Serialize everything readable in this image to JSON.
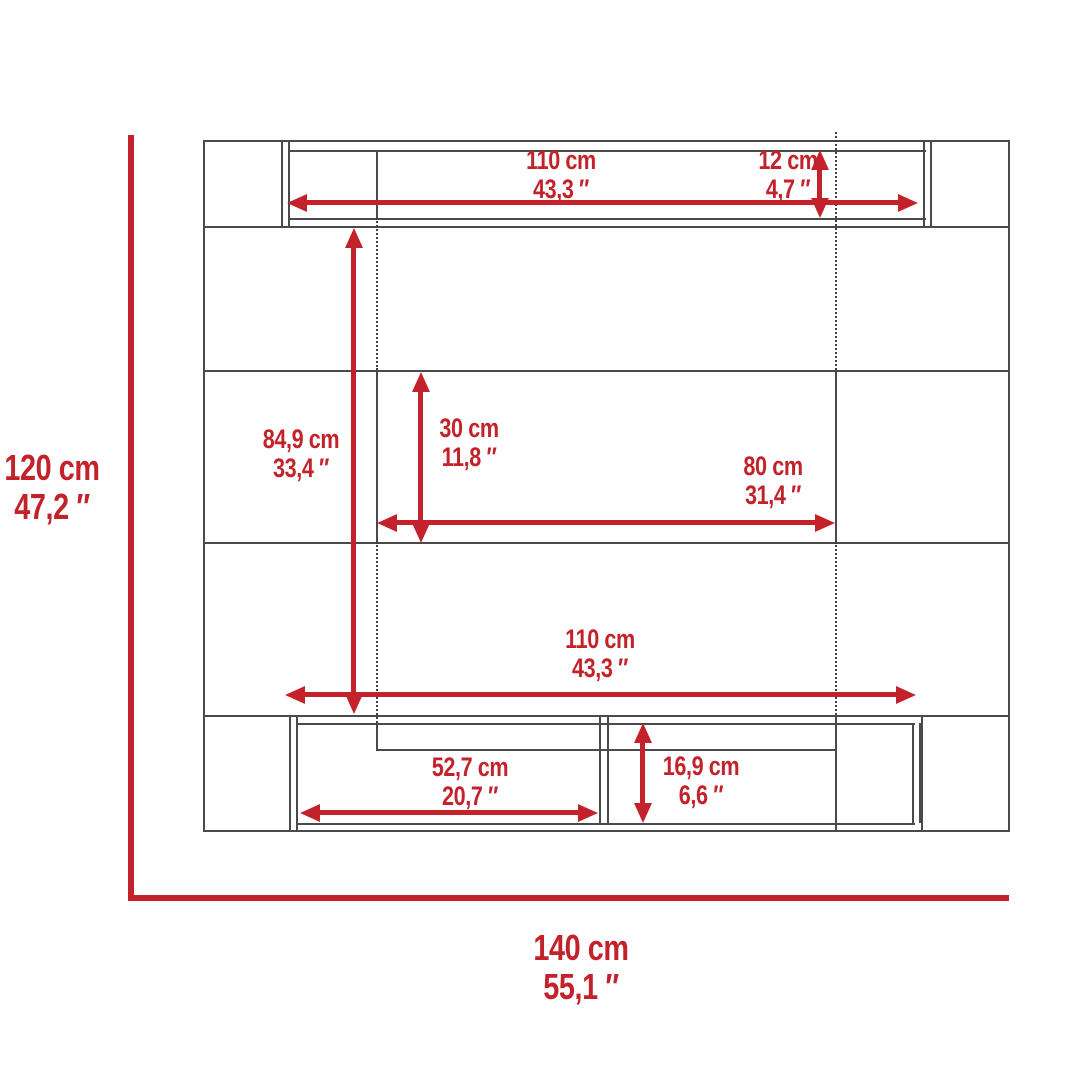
{
  "page": {
    "background": "#ffffff"
  },
  "diagram": {
    "type": "furniture-dimension-diagram",
    "description": "Front-view technical drawing of a wall-mounted entertainment center with dimension arrows",
    "accent_color": "#c4222a",
    "line_color": "#4a4a4a",
    "dimensions": {
      "top_shelf_width": {
        "cm": "110 cm",
        "inch": "43,3 ″"
      },
      "top_shelf_height": {
        "cm": "12 cm",
        "inch": "4,7 ″"
      },
      "overall_height": {
        "cm": "120 cm",
        "inch": "47,2 ″"
      },
      "panel_height": {
        "cm": "84,9 cm",
        "inch": "33,4 ″"
      },
      "center_opening_height": {
        "cm": "30 cm",
        "inch": "11,8 ″"
      },
      "center_shelf_width": {
        "cm": "80 cm",
        "inch": "31,4 ″"
      },
      "lower_opening_width": {
        "cm": "110 cm",
        "inch": "43,3 ″"
      },
      "cabinet_compartment_width": {
        "cm": "52,7 cm",
        "inch": "20,7 ″"
      },
      "cabinet_opening_height": {
        "cm": "16,9 cm",
        "inch": "6,6 ″"
      },
      "overall_width": {
        "cm": "140 cm",
        "inch": "55,1 ″"
      }
    }
  }
}
